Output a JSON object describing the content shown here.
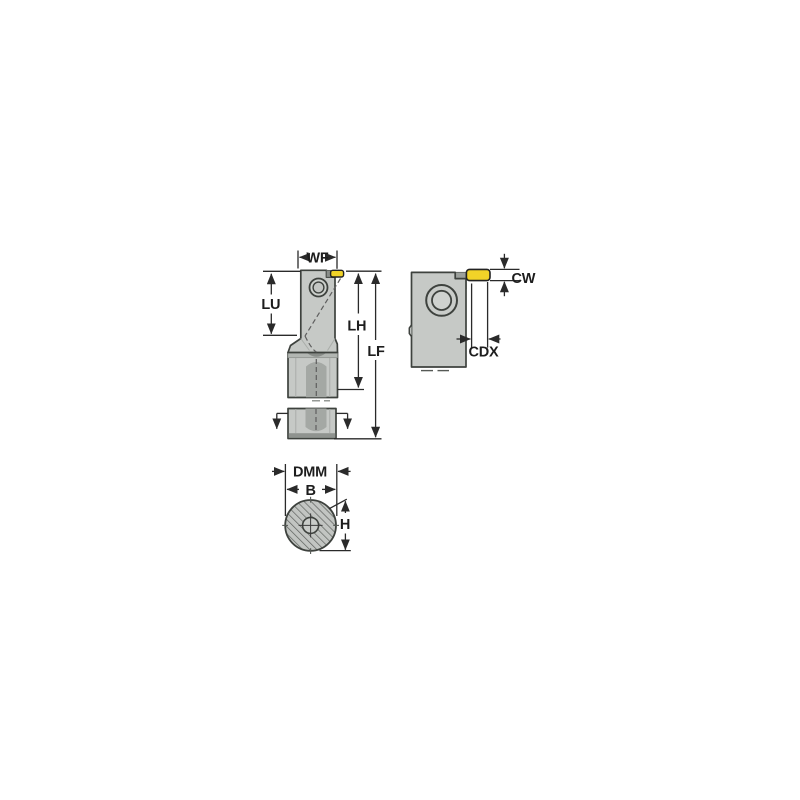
{
  "drawing": {
    "labels": {
      "wf": "WF",
      "lu": "LU",
      "lh": "LH",
      "lf": "LF",
      "cw": "CW",
      "cdx": "CDX",
      "dmm": "DMM",
      "b": "B",
      "h": "H"
    },
    "colors": {
      "insert_yellow": "#f1d328",
      "body_gray": "#c6c9c6",
      "shadow_gray": "#a4a8a4",
      "outline": "#3e423e",
      "dimension_line": "#2a2a2a",
      "hatch_line": "#5e625e",
      "background": "#ffffff"
    }
  }
}
